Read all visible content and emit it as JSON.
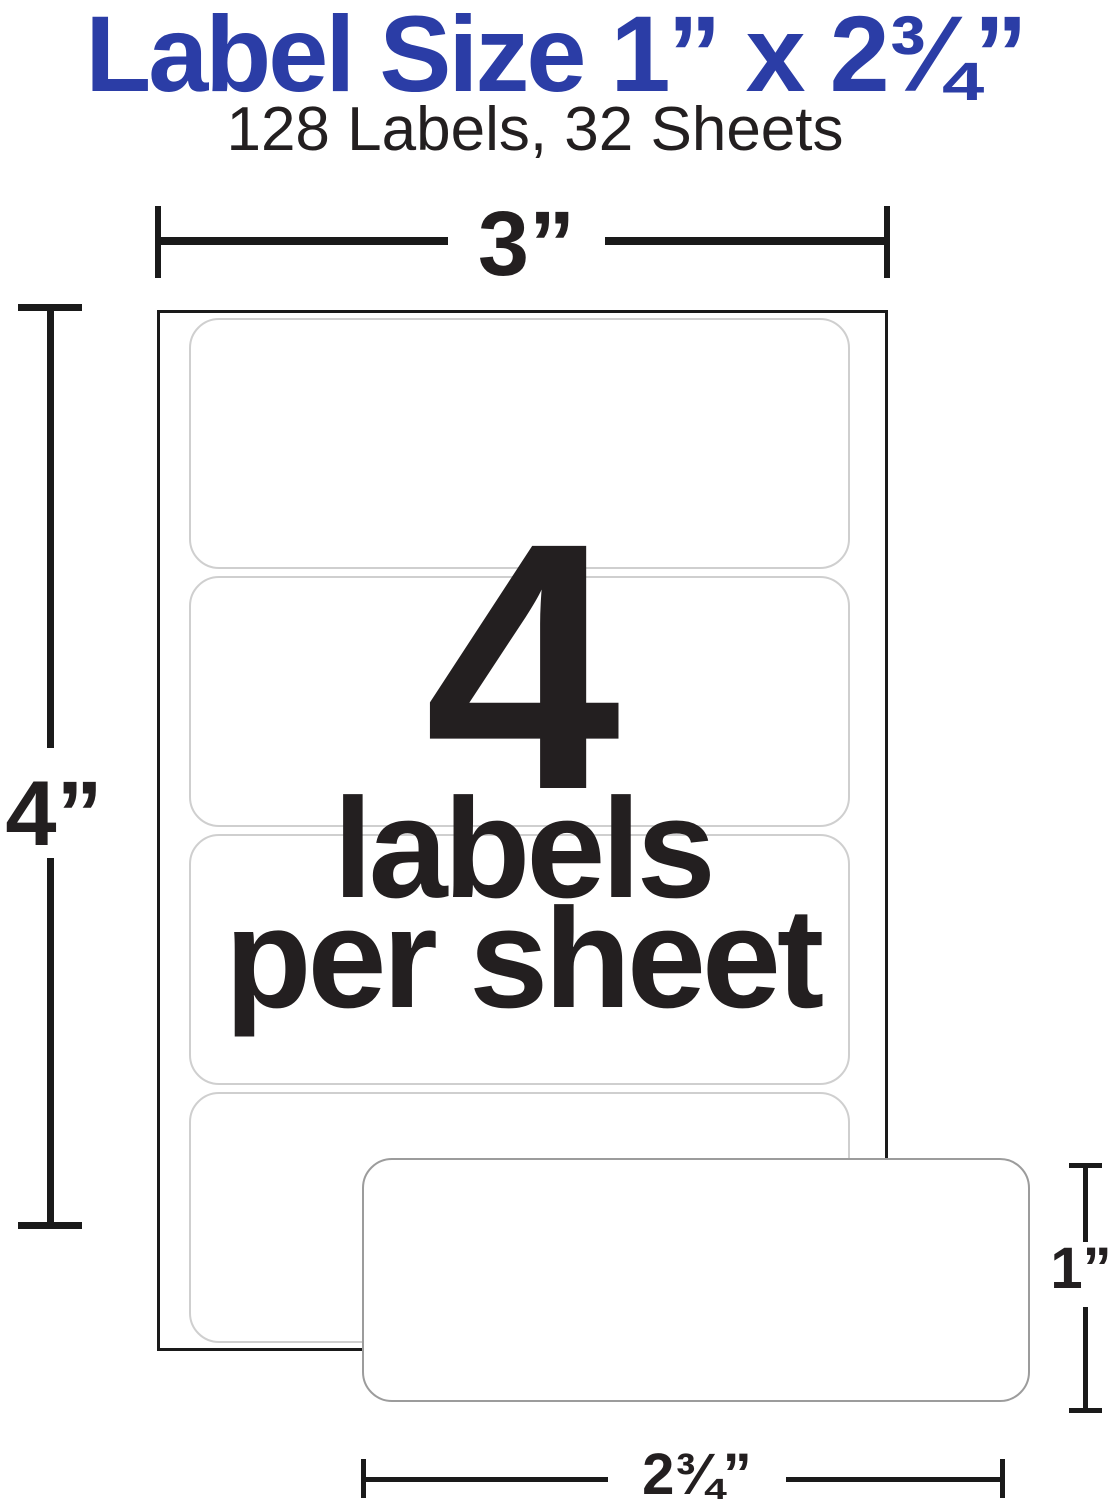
{
  "header": {
    "title": "Label Size 1” x 2¾”",
    "subtitle": "128 Labels, 32 Sheets"
  },
  "sheet_diagram": {
    "width_dimension": "3”",
    "height_dimension": "4”",
    "count": "4",
    "caption_line1": "labels",
    "caption_line2": "per sheet",
    "labels_per_sheet": 4
  },
  "single_label": {
    "height_dimension": "1”",
    "width_dimension": "2¾”"
  },
  "colors": {
    "title_blue": "#2b3da6",
    "text_black": "#231f20",
    "sheet_border": "#1a1a1a",
    "label_outline": "#cfcfcf",
    "single_label_outline": "#9c9c9c",
    "dim_color": "#1a1a1a"
  }
}
